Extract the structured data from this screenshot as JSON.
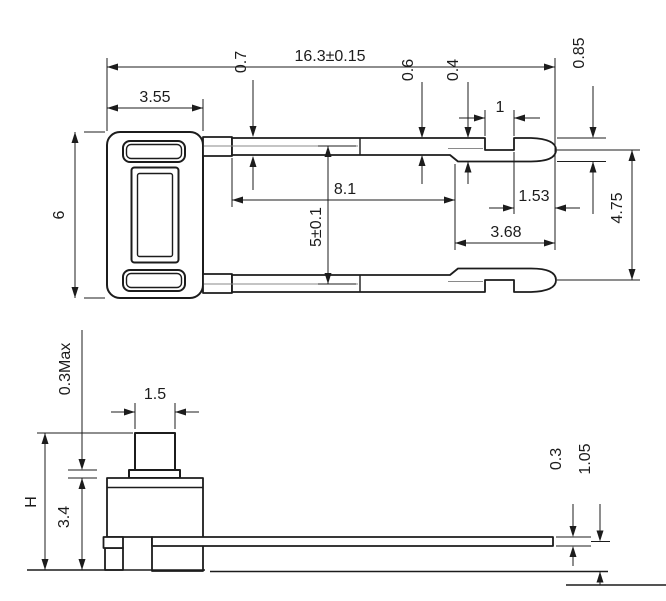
{
  "colors": {
    "line": "#1c1c1c",
    "background": "#ffffff",
    "centerline": "#8a8a8a"
  },
  "top_view": {
    "overall_length": "16.3±0.15",
    "body_width": "3.55",
    "body_height": "6",
    "pin_root_width": "0.7",
    "pin_width": "0.6",
    "notch_remainder": "0.4",
    "tip_height": "0.85",
    "notch_length": "1",
    "pin_straight_length": "8.1",
    "pin_pitch": "5±0.1",
    "tip_length": "1.53",
    "tip_section_length": "3.68",
    "tip_span": "4.75"
  },
  "side_view": {
    "button_clearance": "0.3Max",
    "button_width": "1.5",
    "total_height": "H",
    "body_height": "3.4",
    "lead_thickness": "0.3",
    "lead_centerline_height": "1.05"
  }
}
